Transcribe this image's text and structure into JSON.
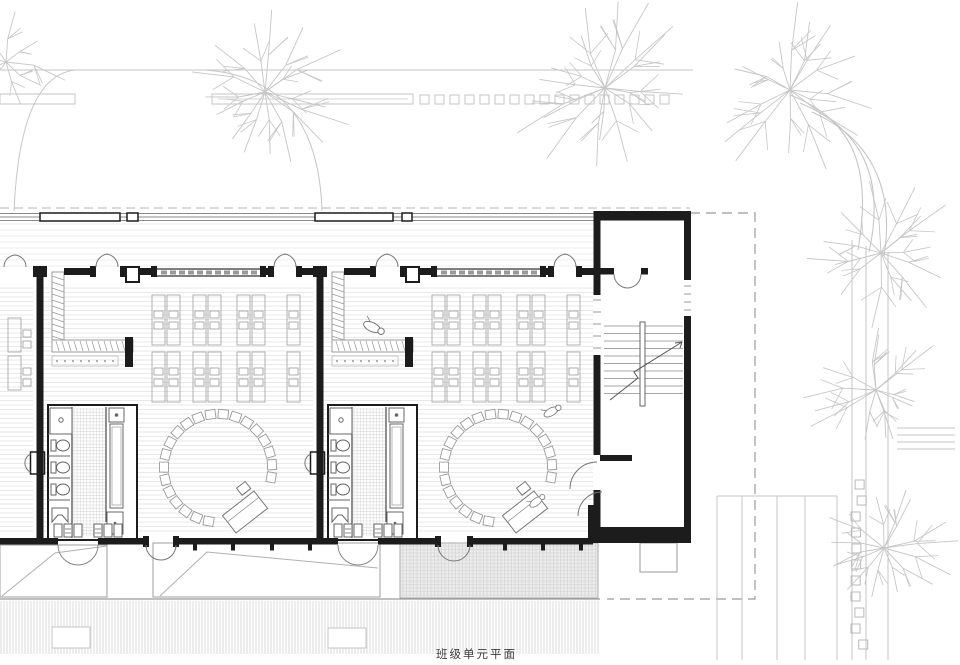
{
  "caption": "班级单元平面",
  "palette": {
    "paper": "#ffffff",
    "wall": "#1c1c1c",
    "dark": "#555555",
    "mid": "#8a8a8a",
    "furn": "#9b9b9b",
    "light": "#c4c4c4",
    "site": "#c6c6c6",
    "floor": "#e0e0e0",
    "grid": "#cfcfcf",
    "hatchfill": "#ececec",
    "deck": "#d2d2d2",
    "dashline": "#9a9a9a",
    "text": "#3a3a3a"
  },
  "drawing": {
    "units": 2,
    "unit_origins_x": [
      40,
      320
    ],
    "stair_core_x": 597,
    "boundary_dashed": [
      [
        690,
        213
      ],
      [
        755,
        213
      ],
      [
        755,
        599
      ],
      [
        607,
        599
      ]
    ],
    "caption_pos": [
      436,
      658
    ]
  }
}
